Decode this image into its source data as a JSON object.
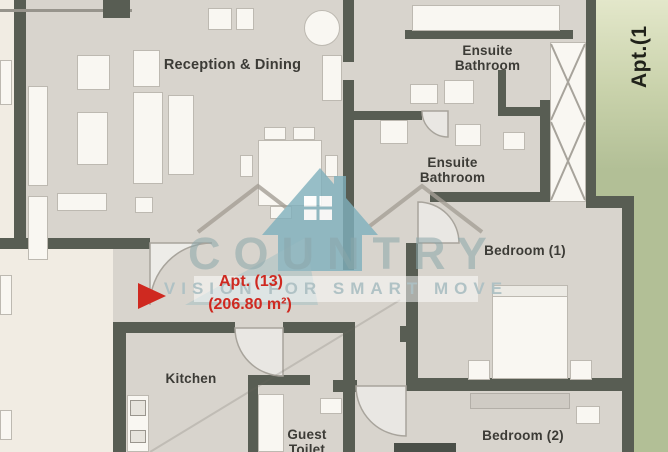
{
  "plan": {
    "apartment_label": "Apt. (13)",
    "apartment_area": "(206.80 m²)",
    "side_label": "Apt.(1",
    "rooms": [
      {
        "id": "reception",
        "label": "Reception & Dining"
      },
      {
        "id": "ensuite-bathroom-1",
        "label": "Ensuite\nBathroom"
      },
      {
        "id": "ensuite-bathroom-2",
        "label": "Ensuite\nBathroom"
      },
      {
        "id": "bedroom-1",
        "label": "Bedroom (1)"
      },
      {
        "id": "bedroom-2",
        "label": "Bedroom (2)"
      },
      {
        "id": "kitchen",
        "label": "Kitchen"
      },
      {
        "id": "guest-toilet",
        "label": "Guest\nToilet"
      }
    ]
  },
  "watermark": {
    "brand": "COUNTRY",
    "tagline": "VISION FOR SMART MOVE"
  },
  "colors": {
    "floor": "#d8d4cd",
    "exterior": "#f1ece3",
    "wall": "#585d53",
    "green": "#b2bf96",
    "green_pale": "#e3e7ca",
    "furniture": "#f9f7f2",
    "furniture_border": "#bdb9b1",
    "label": "#3c3b36",
    "accent_red": "#cf2920",
    "watermark_teal": "#7fb0bd",
    "watermark_text": "#8ca6aa"
  }
}
